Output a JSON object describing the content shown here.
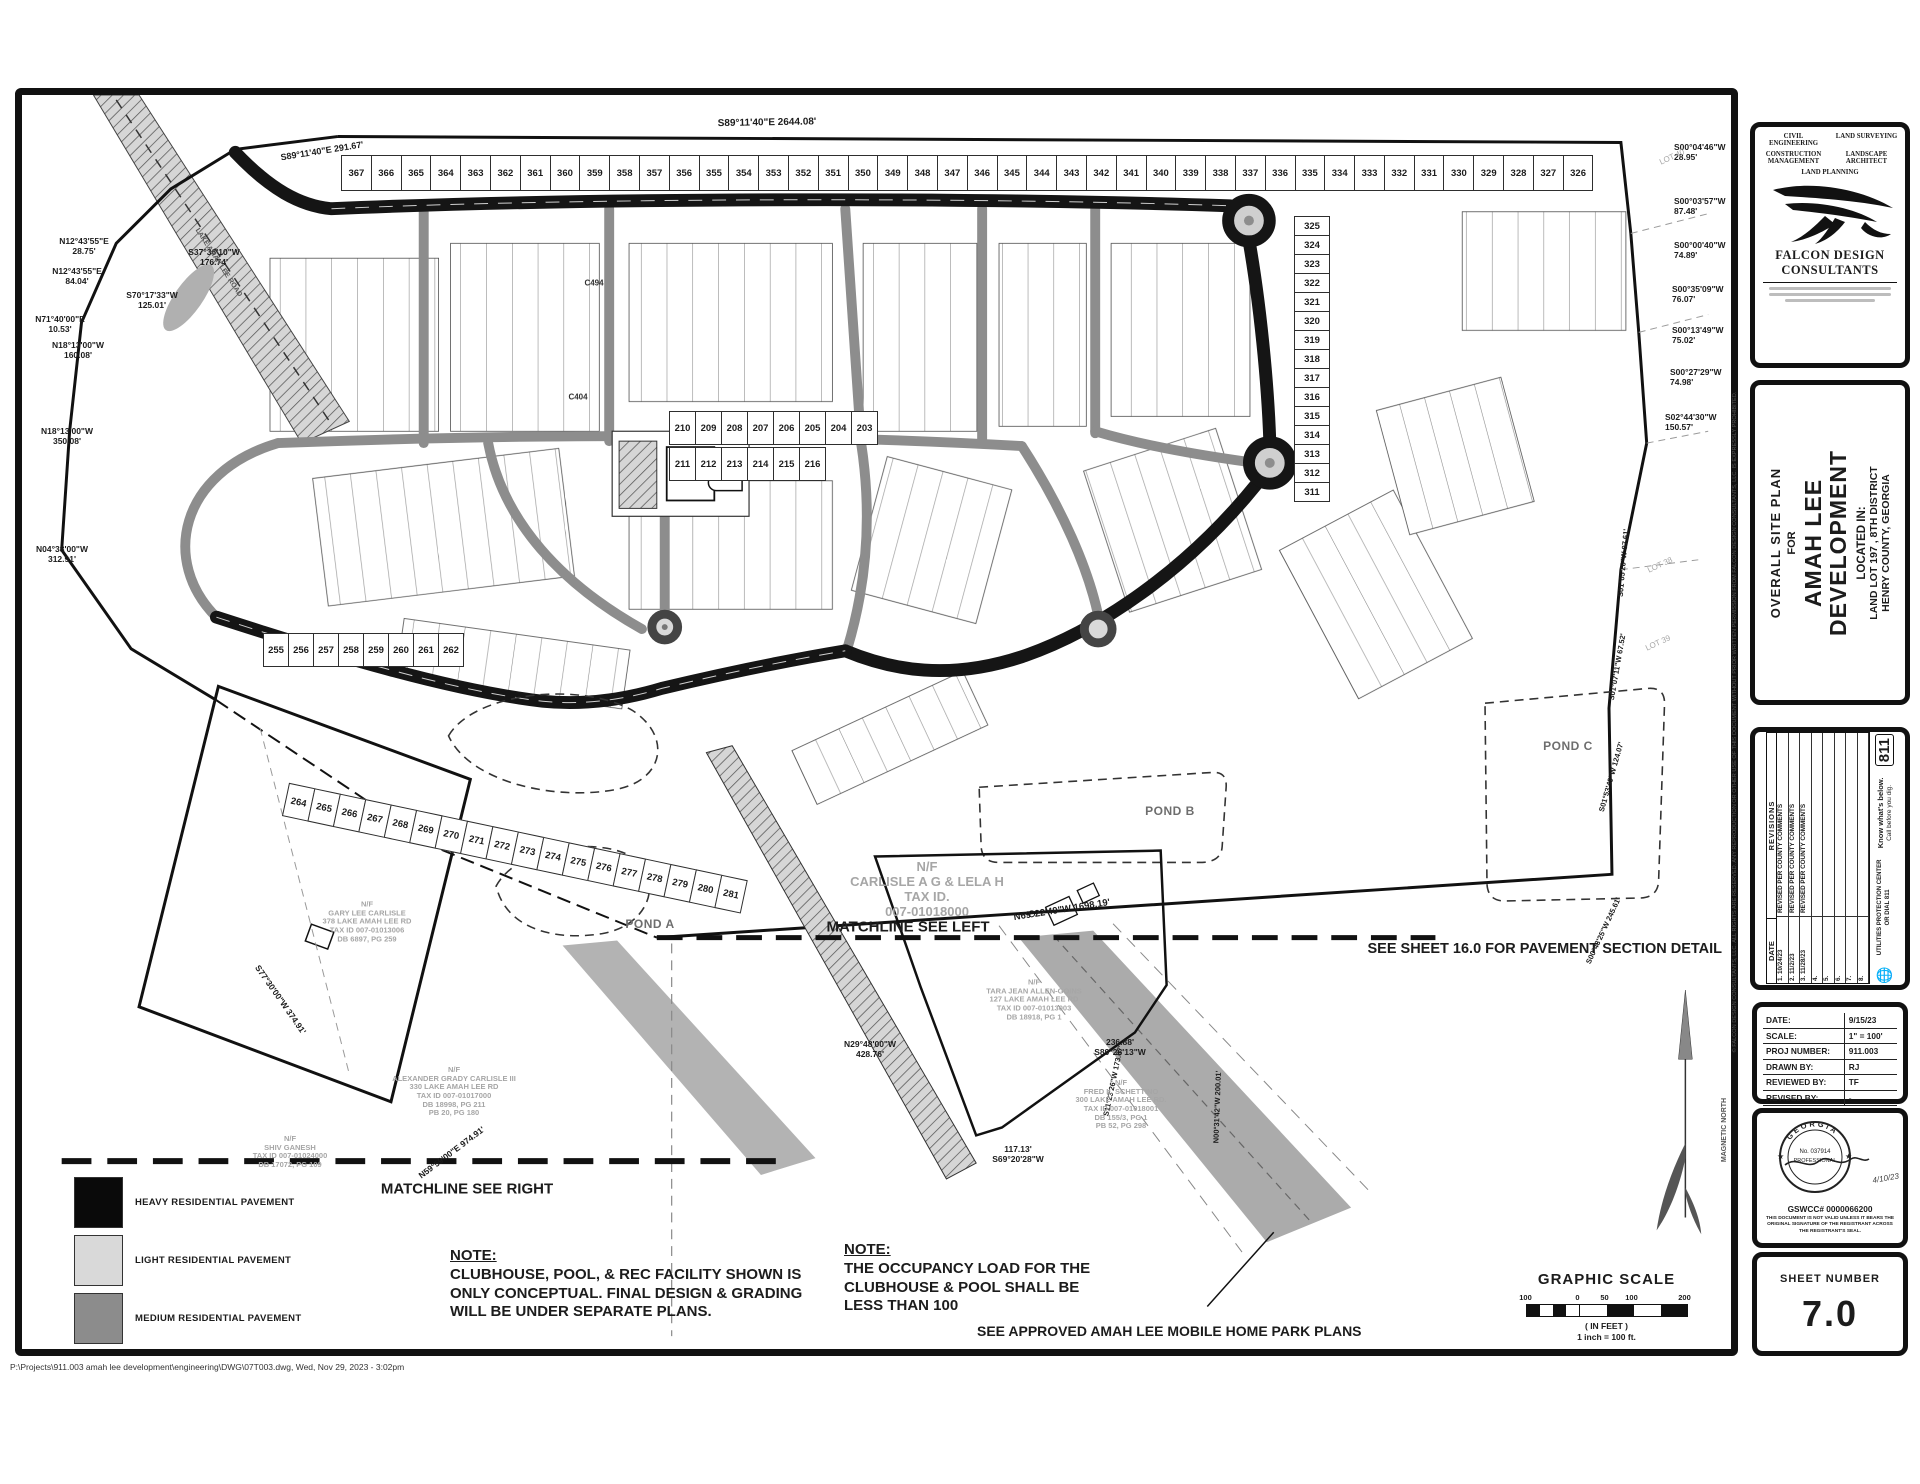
{
  "title_block": {
    "line1": "OVERALL SITE PLAN",
    "line2": "FOR",
    "name1": "AMAH LEE",
    "name2": "DEVELOPMENT",
    "located": "LOCATED IN:",
    "lot": "LAND LOT 197 , 8TH DISTRICT",
    "county": "HENRY COUNTY, GEORGIA"
  },
  "firm": {
    "services": [
      "CIVIL ENGINEERING",
      "LAND SURVEYING",
      "CONSTRUCTION MANAGEMENT",
      "LANDSCAPE ARCHITECT",
      "LAND PLANNING"
    ],
    "name_line1": "FALCON DESIGN",
    "name_line2": "CONSULTANTS"
  },
  "revisions": {
    "title": "REVISIONS",
    "date_header": "DATE",
    "rows": [
      {
        "num": "1.",
        "date": "10/24/23",
        "text": "REVISED PER COUNTY COMMENTS"
      },
      {
        "num": "2.",
        "date": "11/2/23",
        "text": "REVISED PER COUNTY COMMENTS"
      },
      {
        "num": "3.",
        "date": "11/28/23",
        "text": "REVISED PER COUNTY COMMENTS"
      },
      {
        "num": "4.",
        "date": "",
        "text": ""
      },
      {
        "num": "5.",
        "date": "",
        "text": ""
      },
      {
        "num": "6.",
        "date": "",
        "text": ""
      },
      {
        "num": "7.",
        "date": "",
        "text": ""
      },
      {
        "num": "8.",
        "date": "",
        "text": ""
      }
    ],
    "call811": {
      "slogan1": "Know what's below.",
      "slogan2": "Call before you dig.",
      "badge": "811",
      "center1": "UTILITIES PROTECTION CENTER",
      "center2": "OR DIAL 811"
    }
  },
  "info_block": {
    "rows": [
      {
        "label": "DATE:",
        "value": "9/15/23"
      },
      {
        "label": "SCALE:",
        "value": "1\" = 100'"
      },
      {
        "label": "PROJ NUMBER:",
        "value": "911.003"
      },
      {
        "label": "DRAWN BY:",
        "value": "RJ"
      },
      {
        "label": "REVIEWED BY:",
        "value": "TF"
      },
      {
        "label": "REVISED BY:",
        "value": "-"
      }
    ]
  },
  "seal": {
    "state": "GEORGIA",
    "cert": "No. 037914",
    "title": "PROFESSIONAL",
    "date": "4/10/23",
    "gswcc": "GSWCC# 0000066200",
    "disclaimer": "THIS DOCUMENT IS NOT VALID UNLESS IT BEARS THE ORIGINAL SIGNATURE OF THE REGISTRANT ACROSS THE REGISTRANT'S SEAL."
  },
  "sheet_number": {
    "label": "SHEET NUMBER",
    "value": "7.0"
  },
  "scale_bar": {
    "title": "GRAPHIC SCALE",
    "ticks": [
      "100",
      "0",
      "50",
      "100",
      "200"
    ],
    "units": "( IN FEET )",
    "ratio": "1 inch = 100  ft."
  },
  "north": {
    "label": "MAGNETIC NORTH"
  },
  "legend": {
    "items": [
      {
        "name": "HEAVY RESIDENTIAL PAVEMENT",
        "color": "#0a0a0a"
      },
      {
        "name": "LIGHT RESIDENTIAL PAVEMENT",
        "color": "#d9d9d9"
      },
      {
        "name": "MEDIUM RESIDENTIAL PAVEMENT",
        "color": "#8c8c8c"
      }
    ]
  },
  "notes": {
    "note1": {
      "heading": "NOTE:",
      "lines": [
        "CLUBHOUSE, POOL, & REC FACILITY SHOWN IS",
        "ONLY CONCEPTUAL. FINAL DESIGN & GRADING",
        "WILL BE UNDER SEPARATE PLANS."
      ]
    },
    "note2": {
      "heading": "NOTE:",
      "lines": [
        "THE OCCUPANCY LOAD FOR THE",
        "CLUBHOUSE & POOL SHALL BE",
        "LESS THAN 100"
      ]
    },
    "callout": "SEE APPROVED AMAH LEE MOBILE HOME PARK PLANS",
    "pavement_ref": "SEE SHEET 16.0 FOR PAVEMENT SECTION DETAIL"
  },
  "matchlines": {
    "left": "MATCHLINE SEE LEFT",
    "right": "MATCHLINE SEE RIGHT"
  },
  "map": {
    "ponds": [
      {
        "text": "POND A",
        "x": 538,
        "y": 762
      },
      {
        "text": "POND A",
        "x": 628,
        "y": 830
      },
      {
        "text": "POND B",
        "x": 1148,
        "y": 717
      },
      {
        "text": "POND C",
        "x": 1546,
        "y": 652
      }
    ],
    "bearings": [
      {
        "text": [
          "S89°11'40\"E  2644.08'"
        ],
        "x": 745,
        "y": 28,
        "rot": -1,
        "size": 10
      },
      {
        "text": [
          "S89°11'40\"E  291.67'"
        ],
        "x": 300,
        "y": 56,
        "rot": -9,
        "size": 9
      },
      {
        "text": [
          "N12°43'55\"E",
          "28.75'"
        ],
        "x": 62,
        "y": 152,
        "size": 8.5
      },
      {
        "text": [
          "N12°43'55\"E",
          "84.04'"
        ],
        "x": 55,
        "y": 182,
        "size": 8.5
      },
      {
        "text": [
          "S37°36'10\"W",
          "176.74'"
        ],
        "x": 192,
        "y": 163,
        "size": 8.5
      },
      {
        "text": [
          "S70°17'33\"W",
          "125.01'"
        ],
        "x": 130,
        "y": 206,
        "size": 8.5
      },
      {
        "text": [
          "N71°40'00\"E",
          "10.53'"
        ],
        "x": 38,
        "y": 230,
        "size": 8.5
      },
      {
        "text": [
          "N18°13'00\"W",
          "160.08'"
        ],
        "x": 56,
        "y": 256,
        "size": 8.5
      },
      {
        "text": [
          "N18°13'00\"W",
          "350.08'"
        ],
        "x": 45,
        "y": 342,
        "size": 8.5
      },
      {
        "text": [
          "N04°38'00\"W",
          "312.91'"
        ],
        "x": 40,
        "y": 460,
        "size": 8.5
      },
      {
        "text": [
          "S77°30'00\"W  374.91'"
        ],
        "x": 258,
        "y": 905,
        "rot": 55,
        "size": 8.5
      },
      {
        "text": [
          "N59°59'00\"E  974.91'"
        ],
        "x": 430,
        "y": 1058,
        "rot": -37,
        "size": 8.5
      },
      {
        "text": [
          "N69°22'49\"W  1698.19'"
        ],
        "x": 1040,
        "y": 816,
        "rot": -9,
        "size": 9.5
      },
      {
        "text": [
          "S00°04'46\"W",
          "28.95'"
        ],
        "x": 1652,
        "y": 58,
        "size": 8.5,
        "align": "left"
      },
      {
        "text": [
          "S00°03'57\"W",
          "87.48'"
        ],
        "x": 1652,
        "y": 112,
        "size": 8.5,
        "align": "left"
      },
      {
        "text": [
          "S00°00'40\"W",
          "74.89'"
        ],
        "x": 1652,
        "y": 156,
        "size": 8.5,
        "align": "left"
      },
      {
        "text": [
          "S00°35'09\"W",
          "76.07'"
        ],
        "x": 1650,
        "y": 200,
        "size": 8.5,
        "align": "left"
      },
      {
        "text": [
          "S00°13'49\"W",
          "75.02'"
        ],
        "x": 1650,
        "y": 241,
        "size": 8.5,
        "align": "left"
      },
      {
        "text": [
          "S00°27'29\"W",
          "74.98'"
        ],
        "x": 1648,
        "y": 283,
        "size": 8.5,
        "align": "left"
      },
      {
        "text": [
          "S02°44'30\"W",
          "150.57'"
        ],
        "x": 1643,
        "y": 328,
        "size": 8.5,
        "align": "left"
      },
      {
        "text": [
          "S01°05'20\"W  87.61'"
        ],
        "x": 1602,
        "y": 468,
        "rot": -85,
        "size": 7.5
      },
      {
        "text": [
          "S01°07'11\"W  67.52'"
        ],
        "x": 1596,
        "y": 572,
        "rot": -80,
        "size": 7.5
      },
      {
        "text": [
          "S01°53'49\"W  124.07'"
        ],
        "x": 1590,
        "y": 682,
        "rot": -74,
        "size": 7.5
      },
      {
        "text": [
          "S00°43'25\"W  245.61'"
        ],
        "x": 1582,
        "y": 836,
        "rot": -65,
        "size": 7.5
      },
      {
        "text": [
          "N29°48'00\"W",
          "428.76'"
        ],
        "x": 848,
        "y": 955,
        "size": 8.5
      },
      {
        "text": [
          "236.88'",
          "S89°26'13\"W"
        ],
        "x": 1098,
        "y": 953,
        "size": 8.5
      },
      {
        "text": [
          "117.13'",
          "S69°20'28\"W"
        ],
        "x": 996,
        "y": 1060,
        "size": 8.5
      },
      {
        "text": [
          "S11°23'26\"W  173.67'"
        ],
        "x": 1092,
        "y": 986,
        "rot": -78,
        "size": 7.5
      },
      {
        "text": [
          "N00°31'42\"W  200.01'"
        ],
        "x": 1196,
        "y": 1012,
        "rot": -88,
        "size": 7.5
      }
    ],
    "parcels": [
      {
        "text": [
          "N/F",
          "CARLISLE A G & LELA H",
          "TAX ID.",
          "007-01018000"
        ],
        "x": 905,
        "y": 795,
        "size": 13
      },
      {
        "text": [
          "N/F",
          "FRED L. SCHETTINO",
          "300 LAKE AMAH LEE RD.",
          "TAX ID 007-01018001",
          "DB 155/3, PG 1",
          "PB 52, PG 298"
        ],
        "x": 1099,
        "y": 1010,
        "size": 7.5
      },
      {
        "text": [
          "N/F",
          "ALEXANDER GRADY CARLISLE III",
          "330 LAKE AMAH LEE RD",
          "TAX ID 007-01017000",
          "DB 18998, PG 211",
          "PB 20, PG 180"
        ],
        "x": 432,
        "y": 997,
        "size": 7.5
      },
      {
        "text": [
          "N/F",
          "GARY LEE CARLISLE",
          "378 LAKE AMAH LEE RD",
          "TAX ID 007-01013006",
          "DB 6897, PG 259"
        ],
        "x": 345,
        "y": 827,
        "size": 7.5
      },
      {
        "text": [
          "N/F",
          "SHIV GANESH",
          "TAX ID 007-01024000",
          "DB 17072, PG 109"
        ],
        "x": 268,
        "y": 1057,
        "size": 7.5
      },
      {
        "text": [
          "N/F",
          "TARA JEAN ALLEN-GOINS",
          "127 LAKE AMAH LEE RD",
          "TAX ID 007-01013003",
          "DB 18918, PG 1"
        ],
        "x": 1012,
        "y": 905,
        "size": 7.5
      }
    ],
    "adjacent_lots": [
      {
        "text": "LOT 40",
        "x": 1650,
        "y": 62,
        "rot": -25,
        "size": 8
      },
      {
        "text": "LOT 38",
        "x": 1638,
        "y": 470,
        "rot": -25,
        "size": 8
      },
      {
        "text": "LOT 39",
        "x": 1636,
        "y": 548,
        "rot": -25,
        "size": 8
      }
    ],
    "misc_labels": [
      {
        "text": [
          "POOL"
        ],
        "x": 688,
        "y": 384,
        "size": 6.5,
        "color": "#333"
      },
      {
        "text": [
          "LAKE AMAH LEE ROAD"
        ],
        "x": 196,
        "y": 168,
        "rot": 57,
        "size": 7,
        "color": "#555"
      },
      {
        "text": [
          "C494"
        ],
        "x": 572,
        "y": 188,
        "size": 8,
        "color": "#333"
      },
      {
        "text": [
          "C404"
        ],
        "x": 556,
        "y": 302,
        "size": 8,
        "color": "#333"
      },
      {
        "text": [
          "MAGNETIC NORTH"
        ],
        "x": 1703,
        "y": 1035,
        "rot": -90,
        "size": 7,
        "color": "#555"
      }
    ],
    "lot_strips": [
      {
        "from": 367,
        "to": 326,
        "x": 320,
        "y": 60,
        "cw": 30.8,
        "ch": 36
      },
      {
        "from": 325,
        "to": 311,
        "x": 1272,
        "y": 122,
        "cw": 36,
        "ch": 20,
        "vertical": true
      },
      {
        "from": 210,
        "to": 203,
        "x": 648,
        "y": 316,
        "cw": 27,
        "ch": 34
      },
      {
        "from": 211,
        "to": 216,
        "x": 648,
        "y": 352,
        "cw": 27,
        "ch": 34
      },
      {
        "from": 255,
        "to": 262,
        "x": 242,
        "y": 538,
        "cw": 26,
        "ch": 34
      },
      {
        "from": 264,
        "to": 281,
        "x": 268,
        "y": 688,
        "cw": 27,
        "ch": 34,
        "rot": 12
      }
    ]
  },
  "footer": {
    "path": "P:\\Projects\\911.003 amah lee development\\engineering\\DWG\\07T003.dwg,  Wed, Nov 29, 2023 - 3:02pm",
    "copyright": "© FALCON DESIGN CONSULTANTS, LLC.  ALL RIGHTS ARE RESERVED.  ANY REPRODUCTION OR OTHER USE OF THIS DOCUMENT WITHOUT PRIOR WRITTEN PERMISSION FROM FALCON DESIGN CONSULTANTS, LLC. IS EXPRESSLY PROHIBITED."
  }
}
